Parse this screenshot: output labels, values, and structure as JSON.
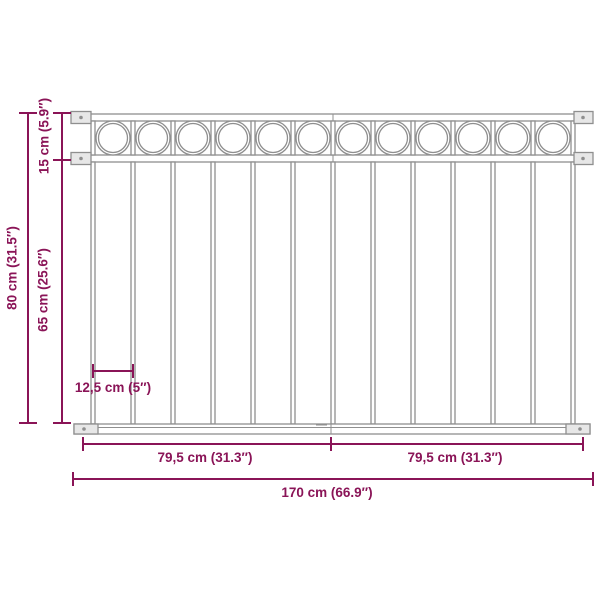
{
  "diagram": {
    "type": "product-dimension-diagram",
    "subject": "fence-panel",
    "labels": {
      "top_rail_height": "15 cm (5.9″)",
      "total_height": "80 cm (31.5″)",
      "lower_section_height": "65 cm (25.6″)",
      "bar_spacing": "12,5 cm (5″)",
      "left_half_width": "79,5 cm (31.3″)",
      "right_half_width": "79,5 cm (31.3″)",
      "total_width": "170 cm (66.9″)"
    },
    "colors": {
      "dimension": "#8a1457",
      "fence": "#8f8f8f",
      "background": "#ffffff"
    },
    "fence": {
      "circle_count": 12,
      "bar_count": 13
    }
  }
}
